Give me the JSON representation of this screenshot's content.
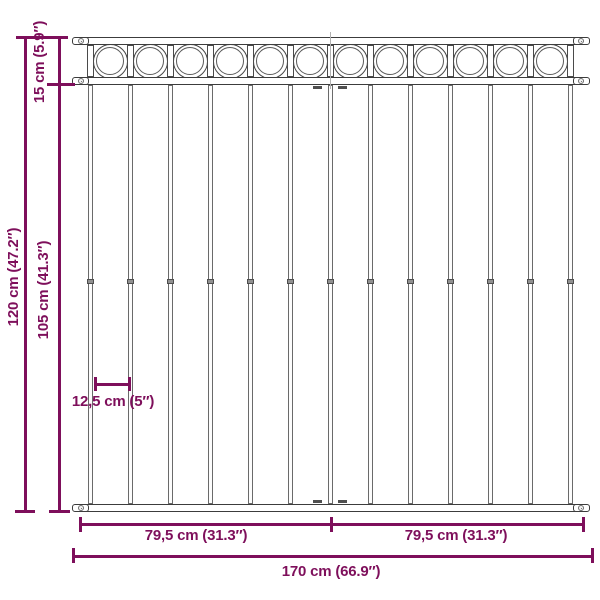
{
  "colors": {
    "accent": "#7E0F5B",
    "outline": "#3C3C3C"
  },
  "fence": {
    "vertical_bar_count": 13,
    "ring_count": 12,
    "post_count": 13,
    "rail_count": 3,
    "screw_count": 6
  },
  "dimensions": {
    "top_section_height": {
      "label": "15 cm (5.9″)"
    },
    "total_height": {
      "label": "120 cm (47.2″)"
    },
    "lower_section_height": {
      "label": "105 cm (41.3″)"
    },
    "bar_spacing": {
      "label": "12,5 cm (5″)"
    },
    "left_half_width": {
      "label": "79,5 cm (31.3″)"
    },
    "right_half_width": {
      "label": "79,5 cm (31.3″)"
    },
    "total_width": {
      "label": "170 cm (66.9″)"
    }
  }
}
